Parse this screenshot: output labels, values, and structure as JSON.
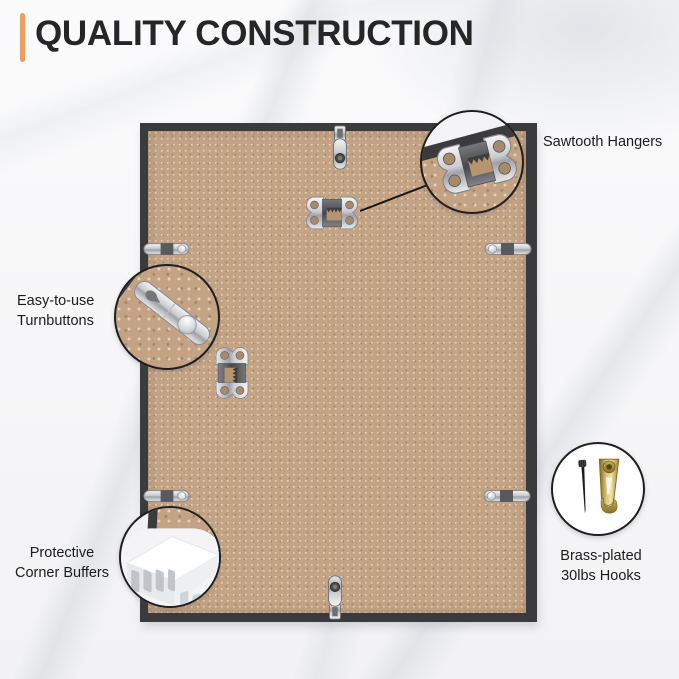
{
  "header": {
    "title": "QUALITY CONSTRUCTION"
  },
  "callouts": {
    "sawtooth": {
      "label": "Sawtooth Hangers"
    },
    "turnbuttons": {
      "line1": "Easy-to-use",
      "line2": "Turnbuttons"
    },
    "corner_buffers": {
      "line1": "Protective",
      "line2": "Corner Buffers"
    },
    "hooks": {
      "line1": "Brass-plated",
      "line2": "30lbs Hooks"
    }
  },
  "hardware_shown": [
    "sawtooth-hanger",
    "turnbutton",
    "retainer-clip",
    "corner-buffer",
    "nail",
    "brass-hook"
  ],
  "colors": {
    "accent": "#EC9E60",
    "frame_border": "#3B3B3D",
    "mdf": "#C3A384",
    "title_text": "#262626",
    "label_text": "#1C1C1C",
    "brass": "#B89B4E"
  }
}
